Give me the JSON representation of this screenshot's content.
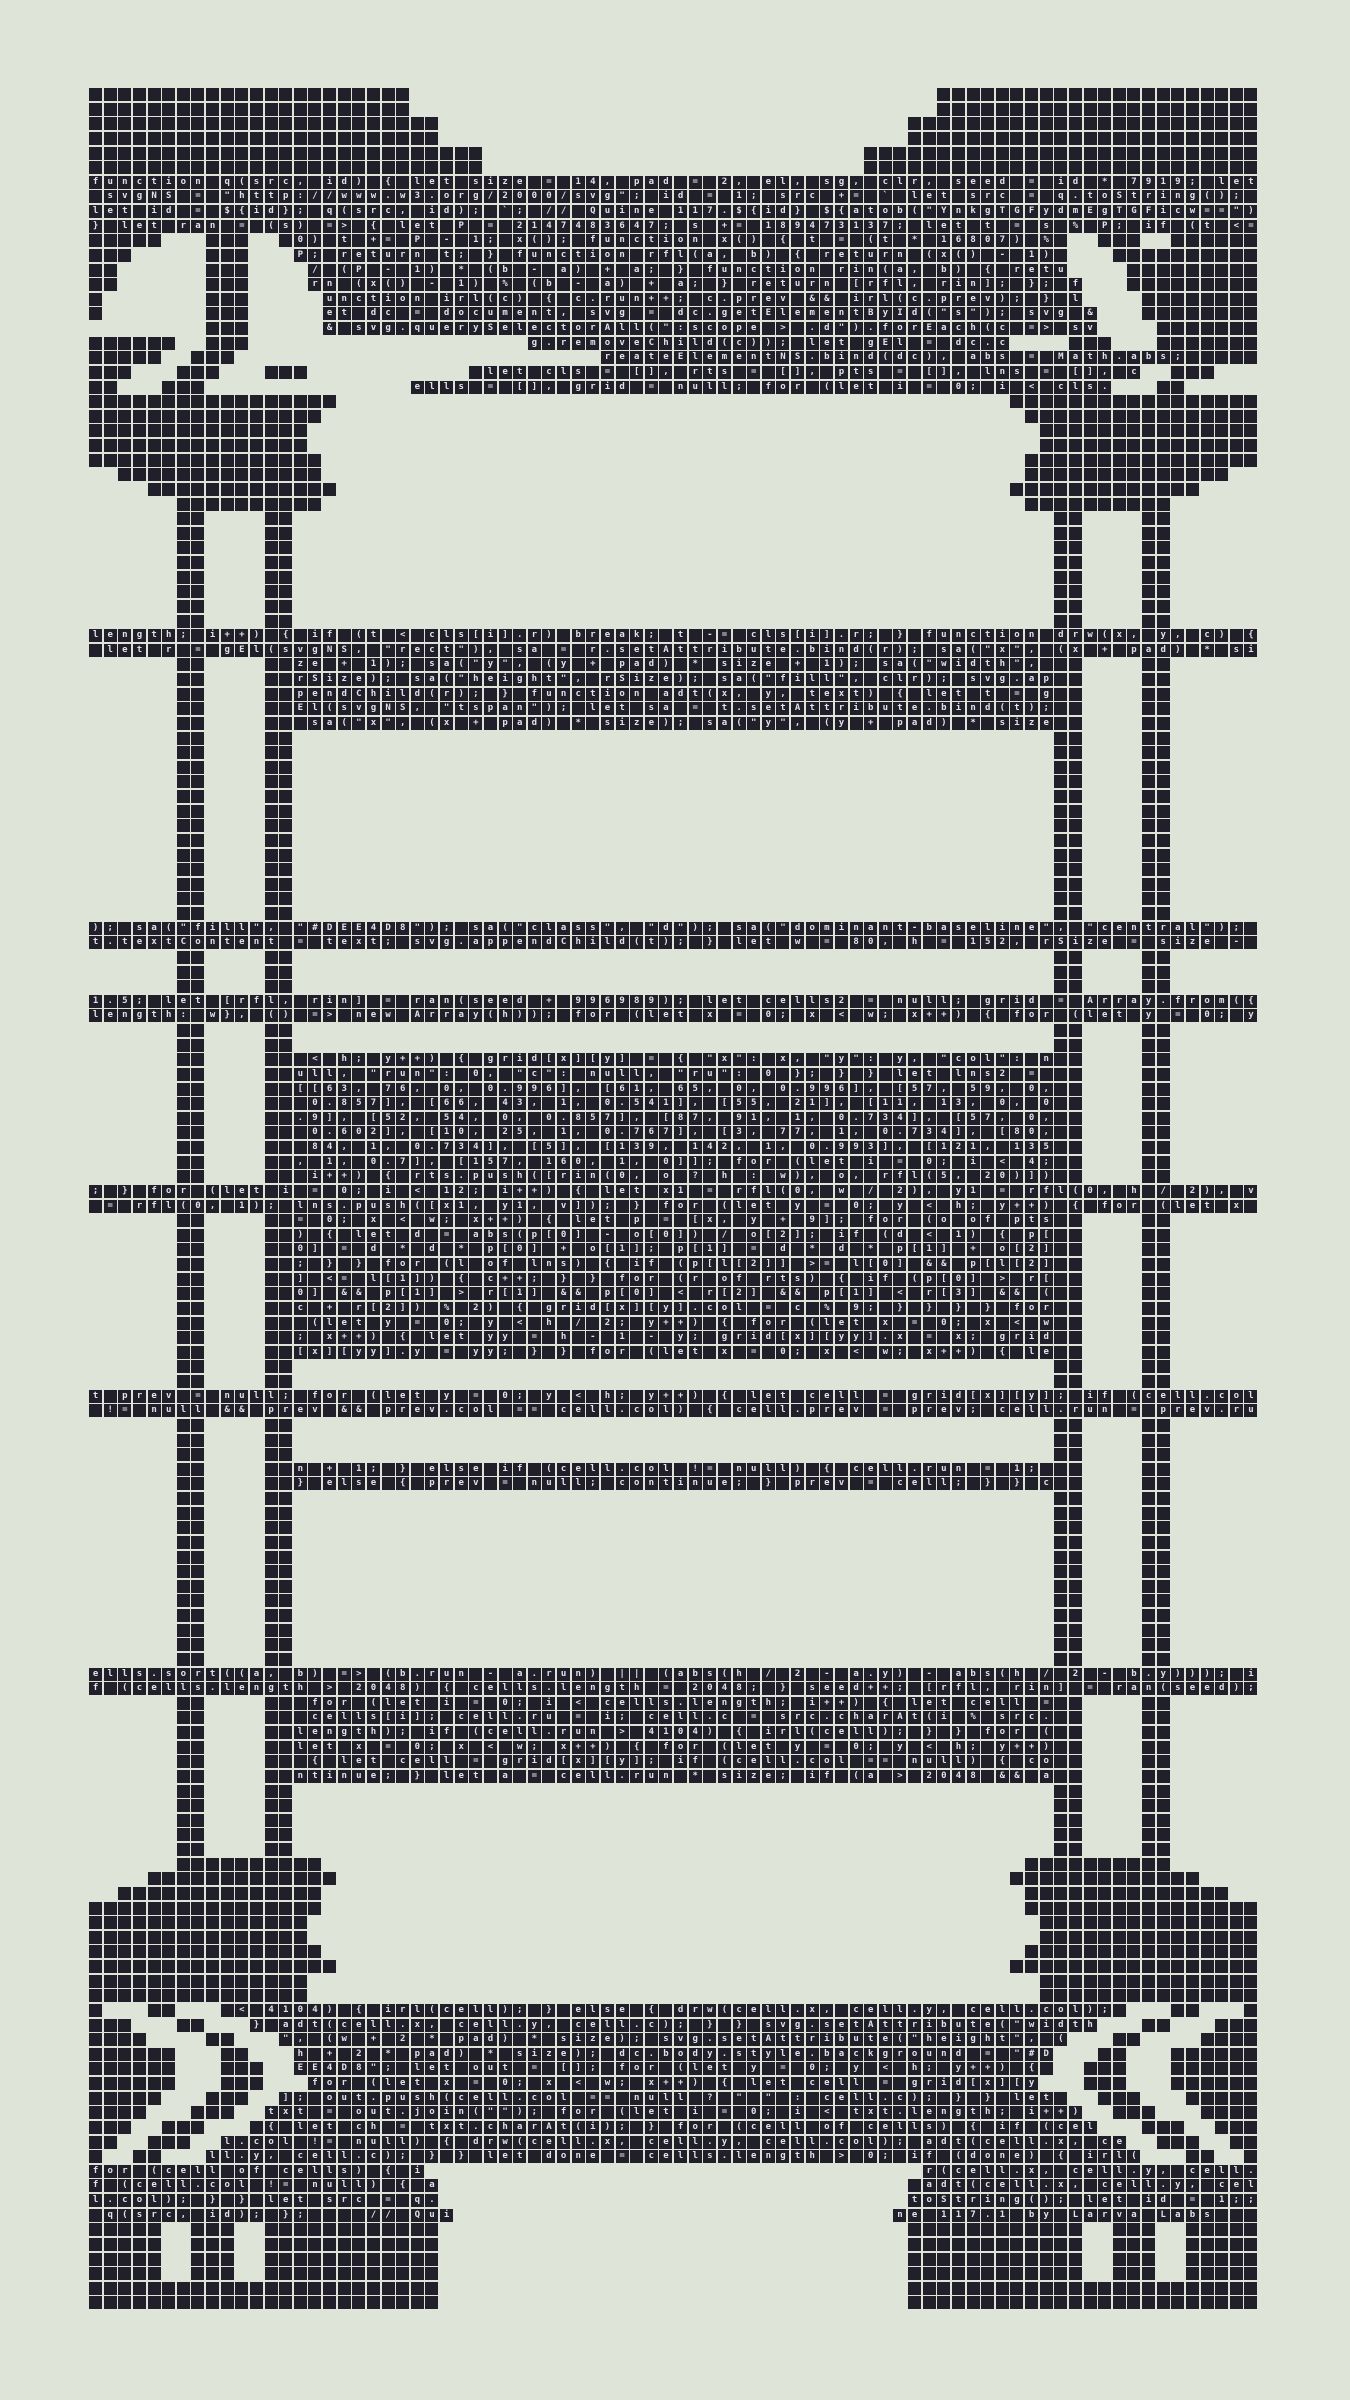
{
  "artwork": {
    "title": "Quine 117.1 by Larva Labs",
    "colors": {
      "background": "#DEE4D8",
      "tile": "#211F29",
      "glyph": "#E4E2EA"
    },
    "grid": {
      "cols": 80,
      "rows": 152,
      "origin_x": 89,
      "origin_y": 88,
      "pitch": 14.625,
      "tile_size": 13.1
    },
    "mask_legend": {
      "#": "blank dark tile",
      "T": "dark tile with code glyph",
      "S": "dark tile with signature glyph",
      ".": "empty background"
    },
    "mask_rows": [
      {
        "p": "22#36.22#",
        "n": 2
      },
      {
        "p": "24#32.24#",
        "n": 2
      },
      {
        "p": "27#26.27#",
        "n": 2
      },
      {
        "p": "80T",
        "n": 4
      },
      {
        "p": "5#3.3#2.54T2.3#2.6#",
        "n": 1
      },
      {
        "p": "3#5.3#3.53T3.10#",
        "n": 1
      },
      {
        "p": "2#6.3#4.52T4.9#",
        "n": 1
      },
      {
        "p": "2#6.3#4.53T3.9#",
        "n": 1
      },
      {
        "p": "1#7.3#5.52T4.8#",
        "n": 1
      },
      {
        "p": "1#7.3#5.53T3.8#",
        "n": 1
      },
      {
        "p": "8.3#5.53T4.7#",
        "n": 1
      },
      {
        "p": "6#2.3#19.33T4.3#3.7#",
        "n": 1
      },
      {
        "p": "5#2.3#25.40T5#",
        "n": 1
      },
      {
        "p": "3#3.3#3.3#11.46T2.3#3.",
        "n": 1
      },
      {
        "p": "2#3.3#14.48T3.2#5.",
        "n": 1
      },
      {
        "p": "17#46.17#",
        "n": 1
      },
      {
        "p": "16#48.16#",
        "n": 1
      },
      {
        "p": "15#50.15#",
        "n": 2
      },
      {
        "p": "16#48.16#",
        "n": 1
      },
      {
        "p": "2.14#48.14#2.",
        "n": 1
      },
      {
        "p": "4.13#46.13#4.",
        "n": 1
      },
      {
        "p": "6.10#48.10#6.",
        "n": 1
      },
      {
        "p": "6.2#4.2#52.2#4.2#6.",
        "n": 8
      },
      {
        "p": "80T",
        "n": 2
      },
      {
        "p": "6.2#4.2#52T2#4.2#6.",
        "n": 5
      },
      {
        "p": "6.2#4.2#52.2#4.2#6.",
        "n": 13
      },
      {
        "p": "80T",
        "n": 2
      },
      {
        "p": "6.2#4.2#52.2#4.2#6.",
        "n": 3
      },
      {
        "p": "80T",
        "n": 2
      },
      {
        "p": "6.2#4.2#52.2#4.2#6.",
        "n": 2
      },
      {
        "p": "6.2#4.2#52T2#4.2#6.",
        "n": 9
      },
      {
        "p": "80T",
        "n": 2
      },
      {
        "p": "6.2#4.2#52T2#4.2#6.",
        "n": 10
      },
      {
        "p": "6.2#4.2#52.2#4.2#6.",
        "n": 2
      },
      {
        "p": "80T",
        "n": 2
      },
      {
        "p": "6.2#4.2#52.2#4.2#6.",
        "n": 3
      },
      {
        "p": "6.2#4.2#52T2#4.2#6.",
        "n": 2
      },
      {
        "p": "6.2#4.2#52.2#4.2#6.",
        "n": 12
      },
      {
        "p": "80T",
        "n": 2
      },
      {
        "p": "6.2#4.2#52T2#4.2#6.",
        "n": 6
      },
      {
        "p": "6.2#4.2#52.2#4.2#6.",
        "n": 5
      },
      {
        "p": "6.10#48.10#6.",
        "n": 1
      },
      {
        "p": "4.13#46.13#4.",
        "n": 1
      },
      {
        "p": "2.14#48.14#2.",
        "n": 1
      },
      {
        "p": "16#48.16#",
        "n": 1
      },
      {
        "p": "15#50.15#",
        "n": 2
      },
      {
        "p": "16#48.16#",
        "n": 1
      },
      {
        "p": "17#46.17#",
        "n": 1
      },
      {
        "p": "15#50.15#",
        "n": 2
      },
      {
        "p": "1#3.2#3.62T3.2#3.1#",
        "n": 1
      },
      {
        "p": "3#3.2#3.58T3.2#3.3#",
        "n": 1
      },
      {
        "p": "4#4.2#3.54T3.2#4.4#",
        "n": 1
      },
      {
        "p": "6#3.2#3.52T3.2#3.6#",
        "n": 1
      },
      {
        "p": "6#3.3#2.52T2.3#3.6#",
        "n": 1
      },
      {
        "p": "6#3.3#3.50T3.3#3.6#",
        "n": 1
      },
      {
        "p": "5#3.3#2.54T2.3#3.5#",
        "n": 1
      },
      {
        "p": "4#3.3#2.56T2.3#3.4#",
        "n": 1
      },
      {
        "p": "3#2.3#3.58T3.3#2.3#",
        "n": 1
      },
      {
        "p": "2#2.3#2.62T2.3#2.2#",
        "n": 1
      },
      {
        "p": "1#2.2#3.64T3.2#2.1#",
        "n": 1
      },
      {
        "p": "23S34.23S",
        "n": 1
      },
      {
        "p": "24S32.24S",
        "n": 2
      },
      {
        "p": "25S30.25S",
        "n": 1
      },
      {
        "p": "5#2.3#2.12#32.12#2.3#2.5#",
        "n": 4
      },
      {
        "p": "24#32.24#",
        "n": 2
      }
    ],
    "code": "function q(src, id) { let size = 14, pad = 2, el, sg, clr, seed = id * 7919; let svgNS = \"http://www.w3.org/2000/svg\"; id = 1; src += ` let src = q.toString(); let id = ${id}; q(src, id); `; // Quine 117.${id} ${atob(\"YnkgTGFydmEgTGFicw==\")} let ran = (s) => { let P = 2147483647; s += 189473137; let t = s % P; if (t <= 0) t += P - 1; x(); function x() { t = (t * 16807) % P; return t; } function rfl(a, b) { return (x() - 1) / (P - 1) * (b - a) + a; } function rin(a, b) { return (x() - 1) % (b - a) + a; } return [rfl, rin]; }; function irl(c) { c.run++; c.prev && irl(c.prev); } let dc = document, svg = dc.getElementById(\"s\"); svg && svg.querySelectorAll(\":scope > .d\").forEach(c => svg.removeChild(c)); let gEl = dc.createElementNS.bind(dc), abs = Math.abs; let cls = [], rts = [], pts = [], lns = [], cells = [], grid = null; for (let i = 0; i < cls.length; i++) { if (t < cls[i].r) break; t -= cls[i].r; } function drw(x, y, c) { let r = gEl(svgNS, \"rect\"), sa = r.setAttribute.bind(r); sa(\"x\", (x + pad) * size + 1); sa(\"y\", (y + pad) * size + 1); sa(\"width\", rSize); sa(\"height\", rSize); sa(\"fill\", clr); svg.appendChild(r); } function adt(x, y, text) { let t = gEl(svgNS, \"tspan\"); let sa = t.setAttribute.bind(t); sa(\"x\", (x + pad) * size); sa(\"y\", (y + pad) * size); sa(\"fill\", \"#DEE4D8\"); sa(\"class\", \"d\"); sa(\"dominant-baseline\", \"central\"); t.textContent = text; svg.appendChild(t); } let w = 80, h = 152, rSize = size - 1.5; let [rfl, rin] = ran(seed + 996989); let cells2 = null; grid = Array.from({length: w}, () => new Array(h)); for (let x = 0; x < w; x++) { for (let y = 0; y < h; y++) { grid[x][y] = { \"x\": x, \"y\": y, \"col\": null, \"run\": 0, \"c\": null, \"ru\": 0 }; } } let lns2 = [[63, 76, 0, 0.996], [61, 65, 0, 0.996], [57, 59, 0, 0.857], [66, 43, 1, 0.541], [55, 21], [11, 13, 0, 0.9], [52, 54, 0, 0.857], [87, 91, 1, 0.734], [57, 0, 0.602], [10, 25, 1, 0.767], [3, 77, 1, 0.734], [80, 84, 1, 0.734], [5], [139, 142, 1, 0.993], [121, 135, 1, 0.7], [157, 160, 1, 0]]; for (let i = 0; i < 4; i++) { rts.push([rin(0, o ? h : w), o, rfl(5, 20)]); } for (let i = 0; i < 12; i++) { let x1 = rfl(0, w / 2), y1 = rfl(0, h / 2), v = rfl(0, 1); lns.push([x1, y1, v]); } for (let y = 0; y < h; y++) { for (let x = 0; x < w; x++) { let p = [x, y + 9]; for (o of pts) { let d = abs(p[0] - o[0]) / o[2]; if (d < 1) { p[0] = d * d * p[0] + o[1]; p[1] = d * d * p[1] + o[2]; } } for (l of lns) { if (p[l[2]] >= l[0] && p[l[2]] <= l[1]) { c++; } } for (r of rts) { if (p[0] > r[0] && p[1] > r[1] && p[0] < r[2] && p[1] < r[3] && (c + r[2]) % 2) { grid[x][y].col = c % 9; } } } } for (let y = 0; y < h / 2; y++) { for (let x = 0; x < w; x++) { let yy = h - 1 - y; grid[x][yy].x = x; grid[x][yy].y = yy; } } for (let x = 0; x < w; x++) { let prev = null; for (let y = 0; y < h; y++) { let cell = grid[x][y]; if (cell.col != null && prev && prev.col == cell.col) { cell.prev = prev; cell.run = prev.run + 1; } else if (cell.col != null) { cell.run = 1; } else { prev = null; continue; } prev = cell; } } cells.sort((a, b) => (b.run - a.run) || (abs(h / 2 - a.y) - abs(h / 2 - b.y))); if (cells.length > 2048) { cells.length = 2048; } seed++; [rfl, rin] = ran(seed); for (let i = 0; i < cells.length; i++) { let cell = cells[i]; cell.ru = i; cell.c = src.charAt(i % src.length); if (cell.run > 4104) { irl(cell); } } for (let x = 0; x < w; x++) { for (let y = 0; y < h; y++) { let cell = grid[x][y]; if (cell.col == null) { continue; } let a = cell.run * size; if (a > 2048 && a < 4104) { irl(cell); } else { drw(cell.x, cell.y, cell.col); } adt(cell.x, cell.y, cell.c); } } svg.setAttribute(\"width\", (w + 2 * pad) * size); svg.setAttribute(\"height\", (h + 2 * pad) * size); dc.body.style.background = \"#DEE4D8\"; let out = []; for (let y = 0; y < h; y++) { for (let x = 0; x < w; x++) { let cell = grid[x][y]; out.push(cell.col == null ? \" \" : cell.c); } } let txt = out.join(\"\"); for (let i = 0; i < txt.length; i++) { let ch = txt.charAt(i); } for (cell of cells) { if (cell.col != null) { drw(cell.x, cell.y, cell.col); adt(cell.x, cell.y, cell.c); } } let done = cells.length > 0; if (done) { irl(cells[0]); } run++; return grid; } let src = q.toString(); let id = 1; q(src, id); let again = () => q(q.toString(), id + 1); setTimeout(again, 60000); // Quine 117.1 by Larva Labs ",
    "signature": "for (cell of cells) { ir(cell.x, cell.y, cell.f (cell.col != null) { a adt(cell.x, cell.y, cell.col); } } let src = q.toString(); let id = 1;; q(src, id); };    // Quine 117.1 by Larva Labs  "
  }
}
